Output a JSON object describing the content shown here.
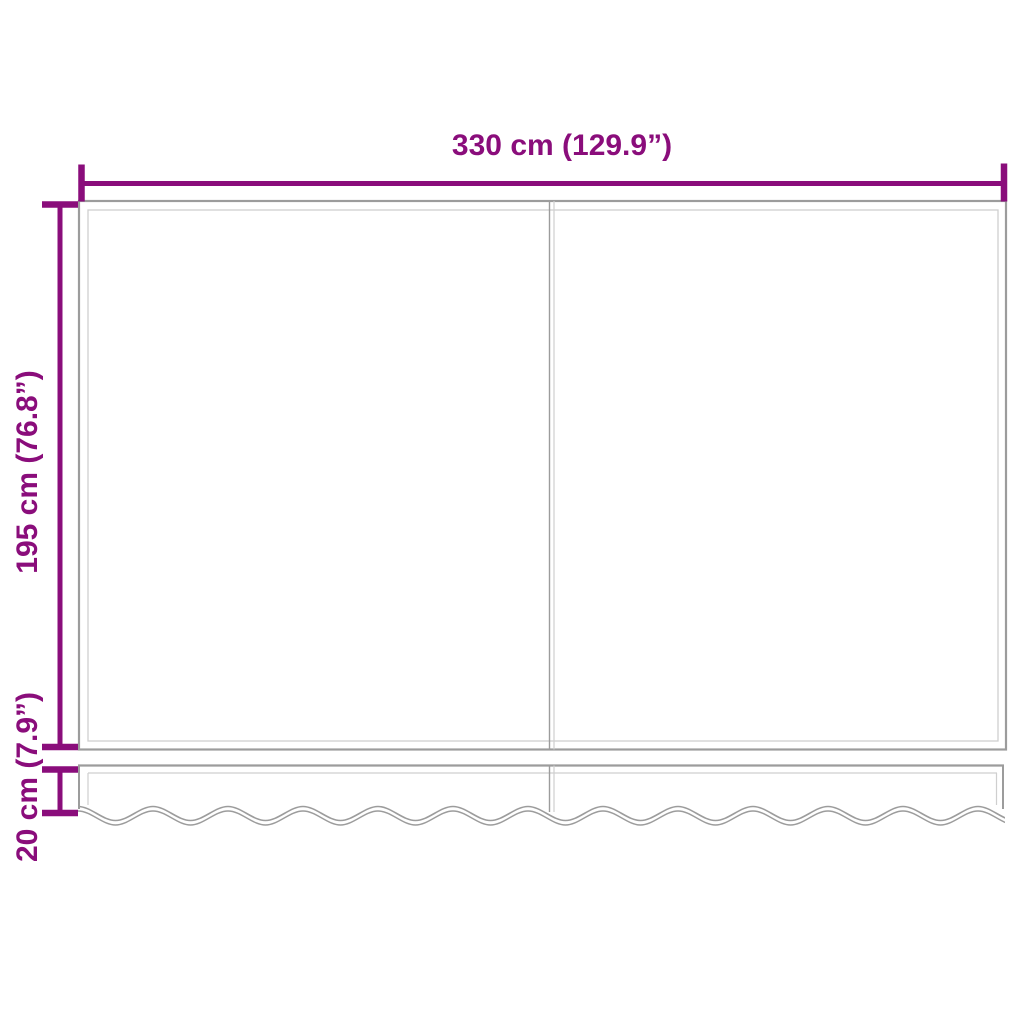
{
  "diagram": {
    "dimension_labels": {
      "width": "330 cm (129.9”)",
      "height": "195 cm (76.8”)",
      "valance_height": "20 cm (7.9”)"
    },
    "colors": {
      "dimension_accent": "#8A0D7B",
      "outline_dark": "#9C9C9C",
      "outline_light": "#CFCFCF",
      "background": "#FFFFFF"
    }
  }
}
